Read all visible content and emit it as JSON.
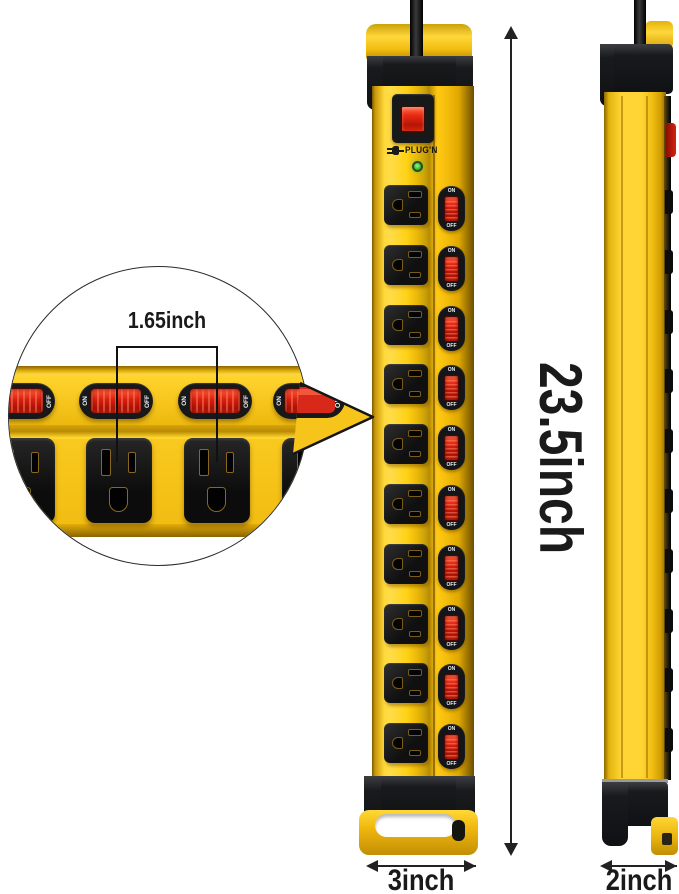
{
  "product": {
    "brand": "PLUG'N",
    "reset_top_label": "OFF",
    "reset_bottom_label": "RESET",
    "front_switches": [
      {
        "on": "ON",
        "off": "OFF"
      },
      {
        "on": "ON",
        "off": "OFF"
      },
      {
        "on": "ON",
        "off": "OFF"
      },
      {
        "on": "ON",
        "off": "OFF"
      },
      {
        "on": "ON",
        "off": "OFF"
      },
      {
        "on": "ON",
        "off": "OFF"
      },
      {
        "on": "ON",
        "off": "OFF"
      },
      {
        "on": "ON",
        "off": "OFF"
      },
      {
        "on": "ON",
        "off": "OFF"
      },
      {
        "on": "ON",
        "off": "OFF"
      }
    ],
    "inset_switches": [
      {
        "on": "ON",
        "off": "OFF"
      },
      {
        "on": "ON",
        "off": "OFF"
      },
      {
        "on": "ON",
        "off": "OFF"
      },
      {
        "on": "ON",
        "off": "OFF"
      }
    ],
    "inset_outlet_count": 4,
    "pointer_switch_off_label": "OFF"
  },
  "dimensions": {
    "height": "23.5inch",
    "width": "3inch",
    "depth": "2inch",
    "outlet_spacing": "1.65inch"
  },
  "colors": {
    "body_yellow": "#F7C41B",
    "switch_red": "#D81F0E",
    "housing_black": "#17181A",
    "led_green": "#2FC832",
    "dimension_text": "#1A1A1A"
  },
  "icons": {
    "brand_plug": "plug-icon"
  }
}
